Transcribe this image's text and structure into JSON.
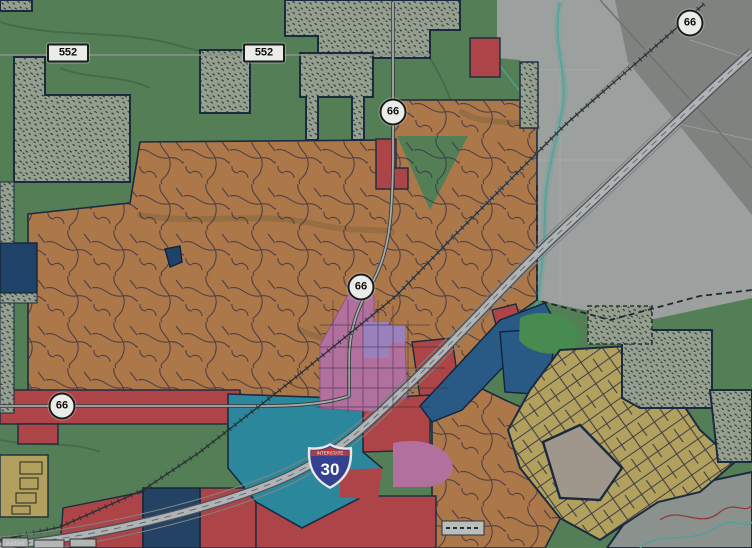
{
  "map": {
    "kind": "municipal zoning / land-use web map over aerial imagery",
    "attribution": "Leaflet |",
    "shields": {
      "route552": {
        "label": "552"
      },
      "route66": {
        "label": "66"
      },
      "interstate30": {
        "banner": "INTERSTATE",
        "label": "30"
      }
    },
    "zones": [
      {
        "name": "single-family-residential",
        "color": "#c08550"
      },
      {
        "name": "agricultural-open-green",
        "color": "#5d8d5e"
      },
      {
        "name": "planned-development-stipple",
        "color": "#a4b09e"
      },
      {
        "name": "commercial-red",
        "color": "#bf4b4f"
      },
      {
        "name": "industrial-teal",
        "color": "#2f97ac"
      },
      {
        "name": "office-dark-blue",
        "color": "#2d6292"
      },
      {
        "name": "downtown-pink",
        "color": "#c47cae"
      },
      {
        "name": "mixed-use-lavender",
        "color": "#ab8fd0"
      },
      {
        "name": "estate-residential-khaki",
        "color": "#c6b267"
      },
      {
        "name": "unincorporated-aerial-gray",
        "color": "#adb2ae"
      }
    ]
  }
}
